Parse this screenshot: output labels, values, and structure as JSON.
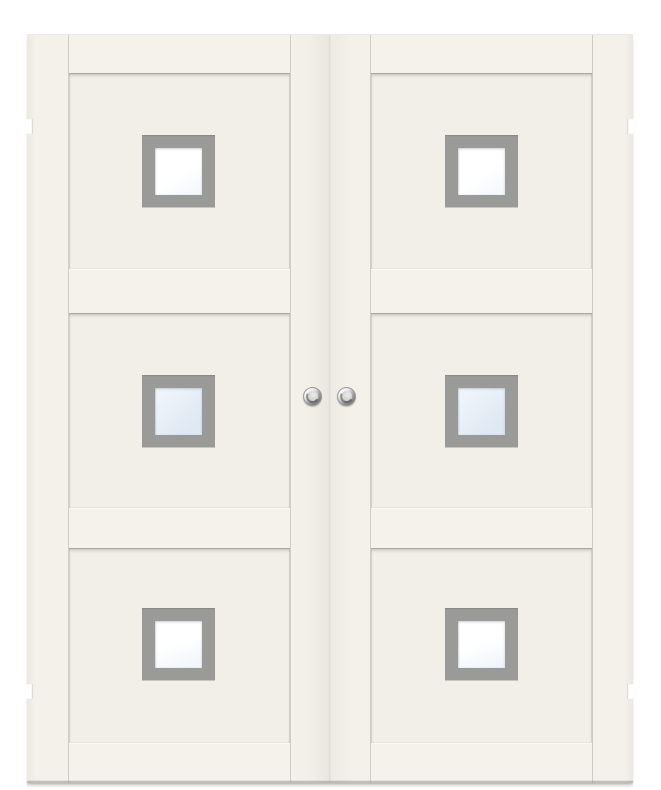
{
  "scene": {
    "description": "Product photograph of a white double interior door pair. Each leaf has three recessed panels separated by horizontal rails; every panel contains a small square window with a grey frame. Two round polished-chrome pull knobs sit at the meeting stiles, and small hinge recesses are visible on the outer edges.",
    "background": "#ffffff"
  },
  "door": {
    "type": "double-door",
    "leaves": [
      {
        "side": "left",
        "panels": 3,
        "windows": 3
      },
      {
        "side": "right",
        "panels": 3,
        "windows": 3
      }
    ],
    "rows": [
      {
        "index": 1,
        "glass_tint": "clear white"
      },
      {
        "index": 2,
        "glass_tint": "pale blue"
      },
      {
        "index": 3,
        "glass_tint": "clear white with faint blue"
      }
    ],
    "hardware": {
      "knobs": 2,
      "knob_finish": "polished chrome",
      "hinge_notches": 4
    }
  },
  "theme": {
    "bg": "#ffffff",
    "face": "#f4f1ea",
    "rail-face": "#f5f2ec",
    "panel-face": "#f2efe8",
    "panel-shadow": "#a9a7a1",
    "edge-line": "#d0cdc6",
    "rail-highlight": "#fbfaf6",
    "joint": "#dcd9d2",
    "frame": "#9a9a98",
    "frame-inner-light": "#c6c6c4",
    "glass-white": "#f2f7fc",
    "glass-blue": "#dfe9f4",
    "glass-white2": "#eef5fb",
    "knob-hi": "#f5f5f5",
    "knob-mid": "#b9b9b9",
    "knob-dark": "#6e6e6e",
    "notch": "#ffffff"
  }
}
